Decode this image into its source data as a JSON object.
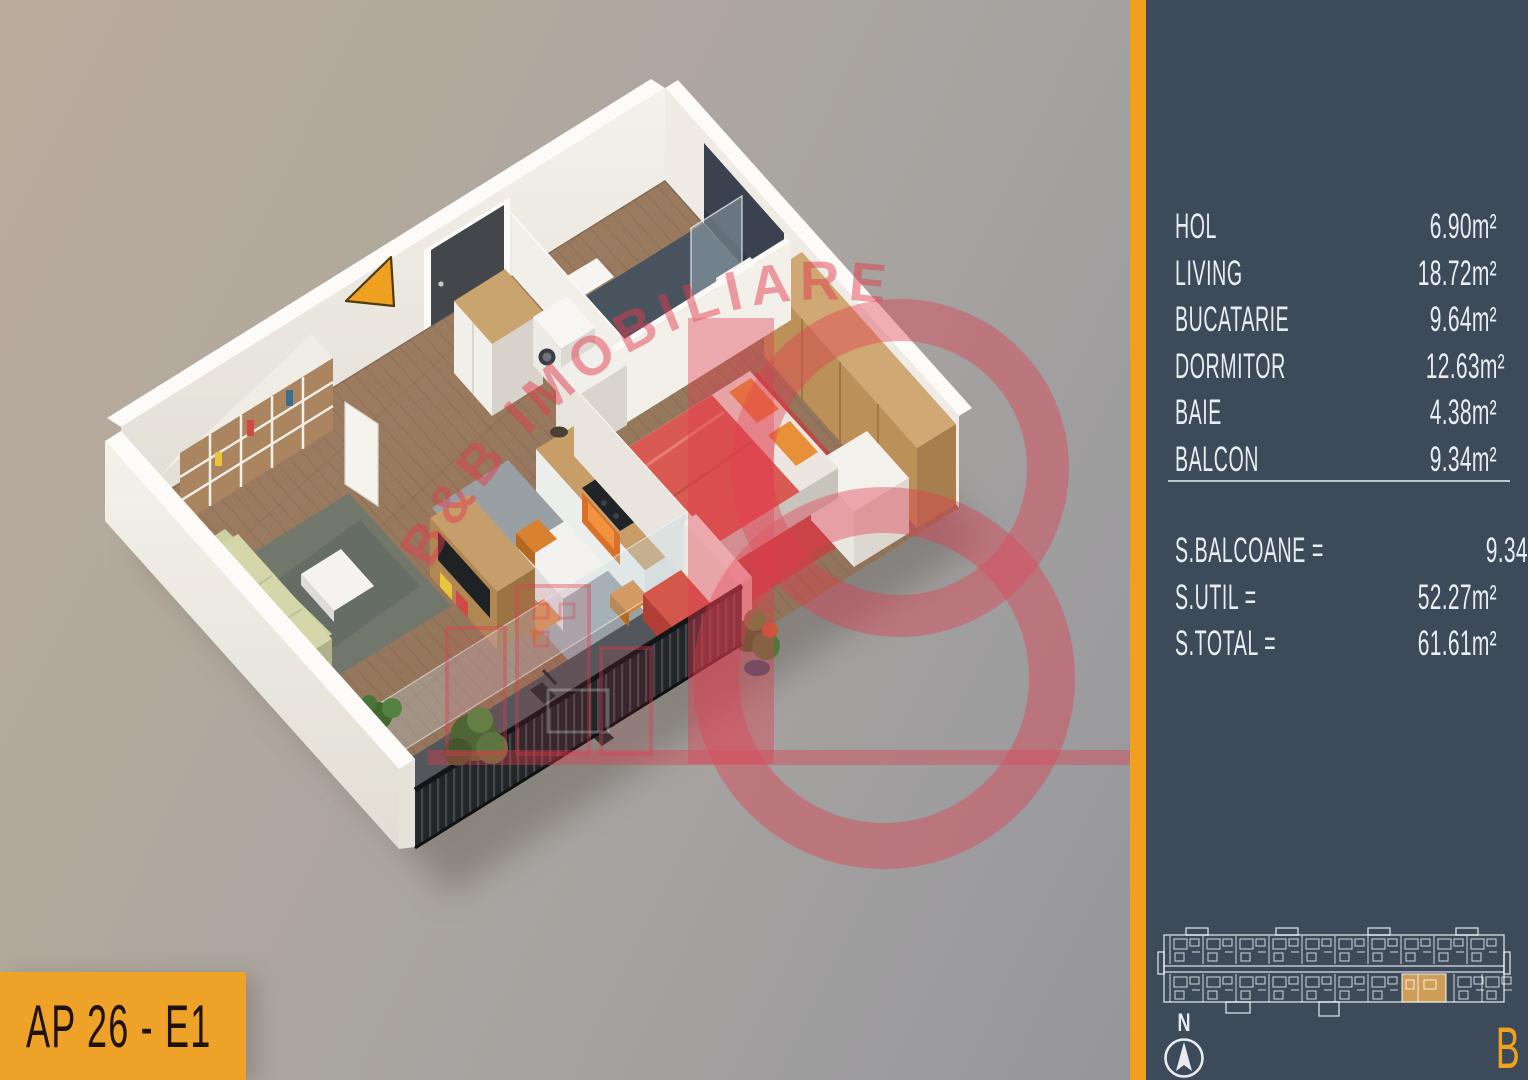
{
  "title_box": {
    "label": "AP 26 - E1"
  },
  "sidebar": {
    "rooms": [
      {
        "label": "HOL",
        "area": "6.90m²"
      },
      {
        "label": "LIVING",
        "area": "18.72m²"
      },
      {
        "label": "BUCATARIE",
        "area": "9.64m²"
      },
      {
        "label": "DORMITOR",
        "area": "12.63m²"
      },
      {
        "label": "BAIE",
        "area": "4.38m²"
      },
      {
        "label": "BALCON",
        "area": "9.34m²"
      }
    ],
    "totals": [
      {
        "label": "S.BALCOANE =",
        "area": "9.34m²"
      },
      {
        "label": "S.UTIL =",
        "area": "52.27m²"
      },
      {
        "label": "S.TOTAL =",
        "area": "61.61m²"
      }
    ],
    "compass": {
      "label": "N"
    },
    "building": {
      "letter": "B"
    }
  },
  "watermark": {
    "text": "B&B IMOBILIARE"
  },
  "colors": {
    "accent_orange": "#EFA31D",
    "sidebar_bg": "#3D4A59",
    "watermark_red": "#E23B4E",
    "unit_highlight": "#D6A257",
    "text_light": "#E9EDF0",
    "title_text": "#201306"
  }
}
